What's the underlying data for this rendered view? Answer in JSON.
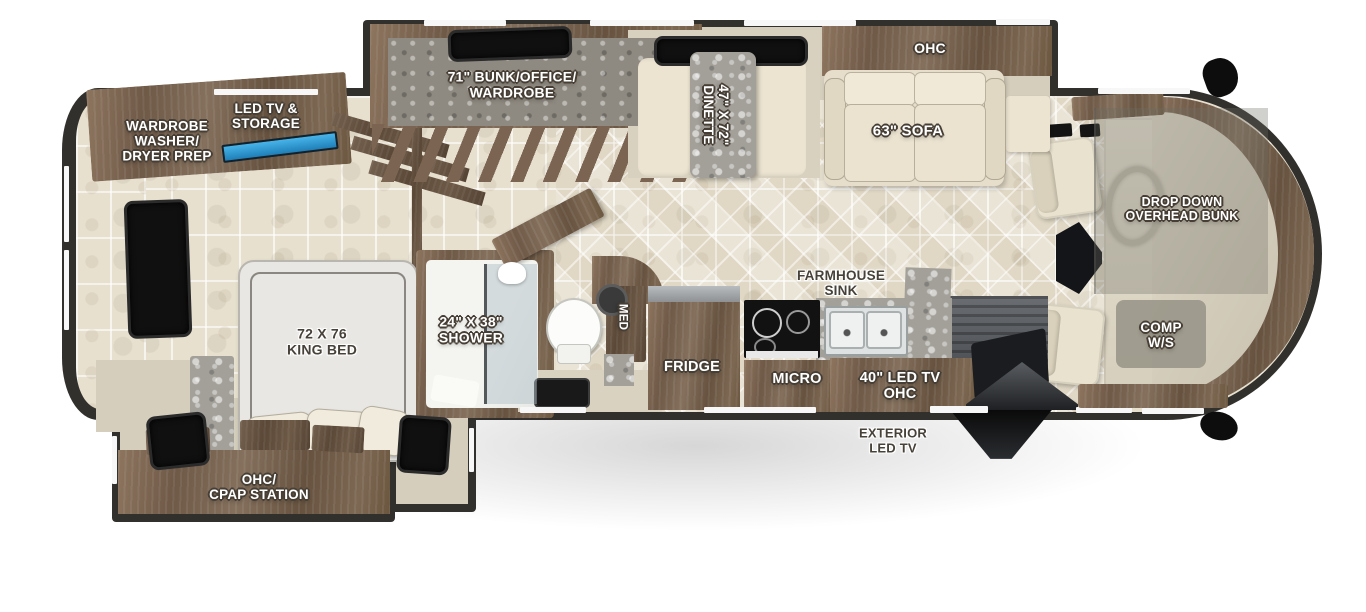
{
  "floorplan": {
    "type": "rv-motorhome-floorplan-top-view",
    "labels": {
      "wardrobe_washer_dryer": "WARDROBE\nWASHER/\nDRYER PREP",
      "led_tv_storage": "LED TV &\nSTORAGE",
      "bunk_office_wardrobe": "71\" BUNK/OFFICE/\nWARDROBE",
      "dinette": "47\" X 72\"\nDINETTE",
      "ohc_living": "OHC",
      "sofa": "63\" SOFA",
      "drop_down_bunk": "DROP DOWN\nOVERHEAD BUNK",
      "comp_workstation": "COMP\nW/S",
      "king_bed": "72 X 76\nKING BED",
      "shower": "24\" X 38\"\nSHOWER",
      "med_cabinet": "MED",
      "fridge": "FRIDGE",
      "farmhouse_sink": "FARMHOUSE\nSINK",
      "micro": "MICRO",
      "led_tv_ohc": "40\" LED TV\nOHC",
      "exterior_led_tv": "EXTERIOR\nLED TV",
      "ohc_cpap_station": "OHC/\nCPAP STATION"
    },
    "colors": {
      "wall": "#32302c",
      "wood_cabinet": "#7e6753",
      "floor_tile": "#e7e0cf",
      "cream_furniture": "#ece4d1",
      "granite_counter": "#a3a099",
      "tv_accent_blue": "#2f9bd8",
      "window_glass": "#101010",
      "label_light": "#ffffff",
      "label_dark": "#474239"
    }
  }
}
